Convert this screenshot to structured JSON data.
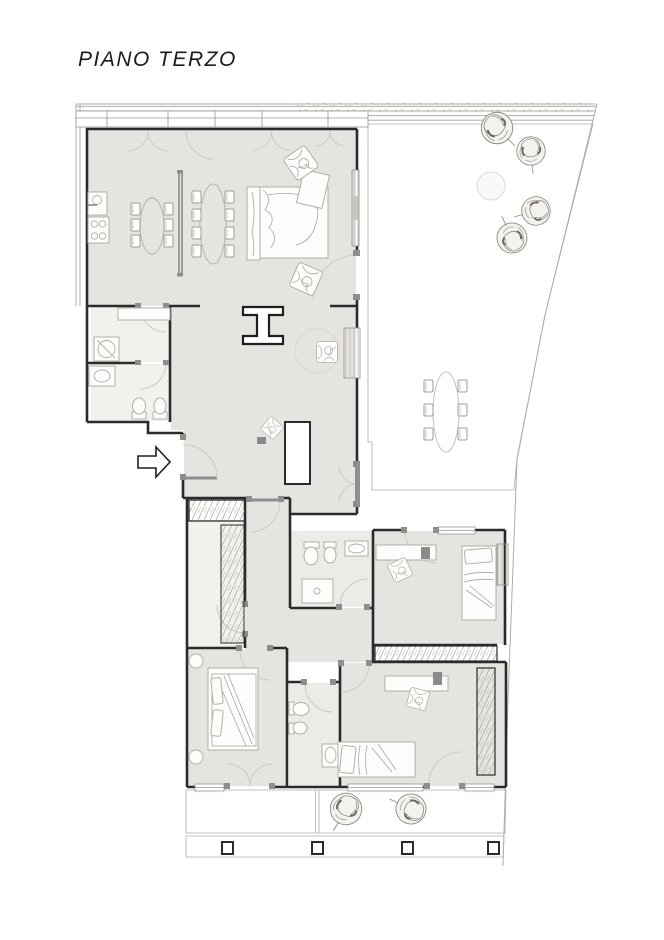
{
  "title": "PIANO TERZO",
  "colors": {
    "background": "#ffffff",
    "wall": "#2b2b2b",
    "floor": "#e6e4e0",
    "floor_light": "#f2f1ee",
    "deck_line": "#a7a29b",
    "door_arc": "#cfccc5",
    "door_jamb": "#8e8e8e",
    "furniture_outline": "#b2aea6",
    "boundary_line": "#b0aca4",
    "tree_stroke": "#8f8b83",
    "title_text": "#1c1c1c"
  },
  "icons": {
    "tree": "scribbled circle (potted plant, plan view)",
    "entrance_arrow": "white right-pointing arrow with black outline",
    "washing_machine": "square with circle and diagonal",
    "stove": "rectangle with four burner circles",
    "sink": "rectangle with basin oval",
    "door_swing": "quarter-circle arc"
  }
}
